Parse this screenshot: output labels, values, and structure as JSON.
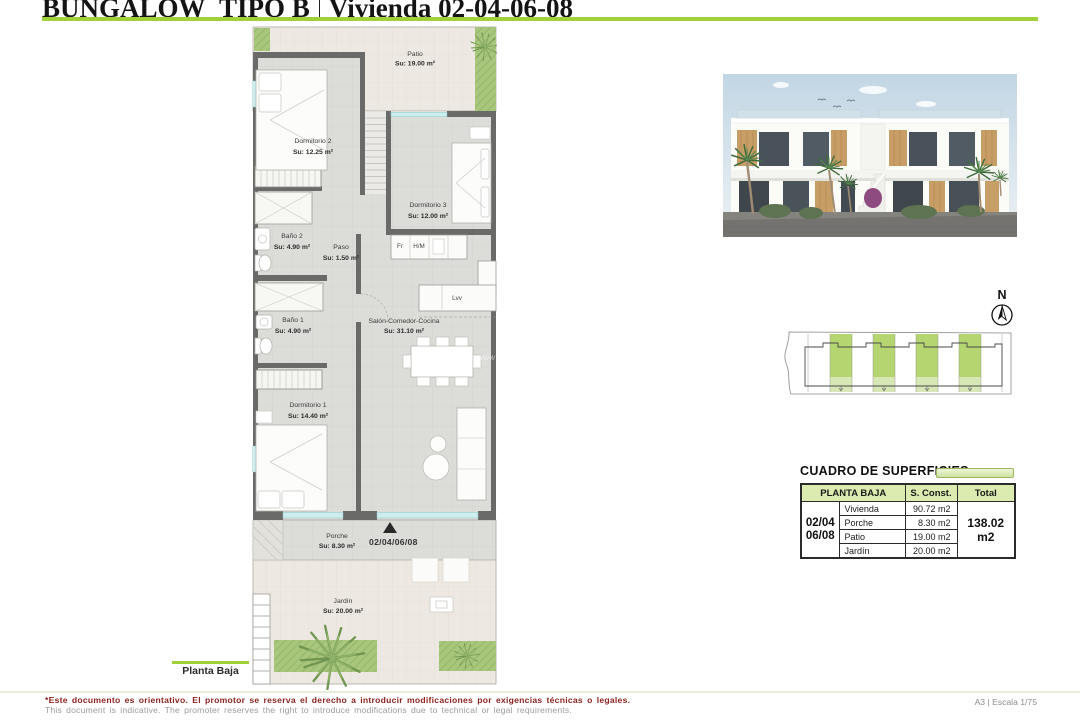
{
  "page": {
    "title": {
      "project": "BUNGALOW_TIPO B",
      "unit": "Vivienda 02-04-06-08"
    },
    "caption": "Planta Baja",
    "scale_note": "A3 | Escala 1/75",
    "disclaimer_es": "*Este documento es orientativo. El promotor se reserva el derecho a introducir modificaciones por exigencias técnicas o legales.",
    "disclaimer_en": "This document is indicative. The promoter reserves the right to introduce modifications due to technical or legal requirements.",
    "accent_color": "#a2d038"
  },
  "plan": {
    "rooms": {
      "patio": {
        "name": "Patio",
        "area": "Su: 19.00 m²"
      },
      "dormitorio2": {
        "name": "Dormitorio 2",
        "area": "Su: 12.25 m²"
      },
      "dormitorio3": {
        "name": "Dormitorio 3",
        "area": "Su: 12.00 m²"
      },
      "bano2": {
        "name": "Baño 2",
        "area": "Su: 4.90 m²"
      },
      "paso": {
        "name": "Paso",
        "area": "Su: 1.50 m²"
      },
      "bano1": {
        "name": "Baño 1",
        "area": "Su: 4.90 m²"
      },
      "salon": {
        "name": "Salón-Comedor-Cocina",
        "area": "Su: 31.10 m²"
      },
      "dormitorio1": {
        "name": "Dormitorio 1",
        "area": "Su: 14.40 m²"
      },
      "porche": {
        "name": "Porche",
        "area": "Su: 8.30 m²"
      },
      "jardin": {
        "name": "Jardín",
        "area": "Su: 20.00 m²"
      }
    },
    "appliances": {
      "fridge": "Fr",
      "oven_micro": "H/M",
      "dishwasher": "Lvv"
    },
    "entrance_units": "02/04/06/08",
    "watermark": "www"
  },
  "north_arrow": {
    "label": "N"
  },
  "surfaces": {
    "heading": "CUADRO DE SUPERFICIES",
    "floor_label": "PLANTA BAJA",
    "col_sconst": "S. Const.",
    "col_total": "Total",
    "unit_line1": "02/04",
    "unit_line2": "06/08",
    "rows": [
      {
        "label": "Vivienda",
        "value": "90.72 m2"
      },
      {
        "label": "Porche",
        "value": "8.30 m2"
      },
      {
        "label": "Patio",
        "value": "19.00 m2"
      },
      {
        "label": "Jardín",
        "value": "20.00 m2"
      }
    ],
    "total": "138.02 m2"
  }
}
